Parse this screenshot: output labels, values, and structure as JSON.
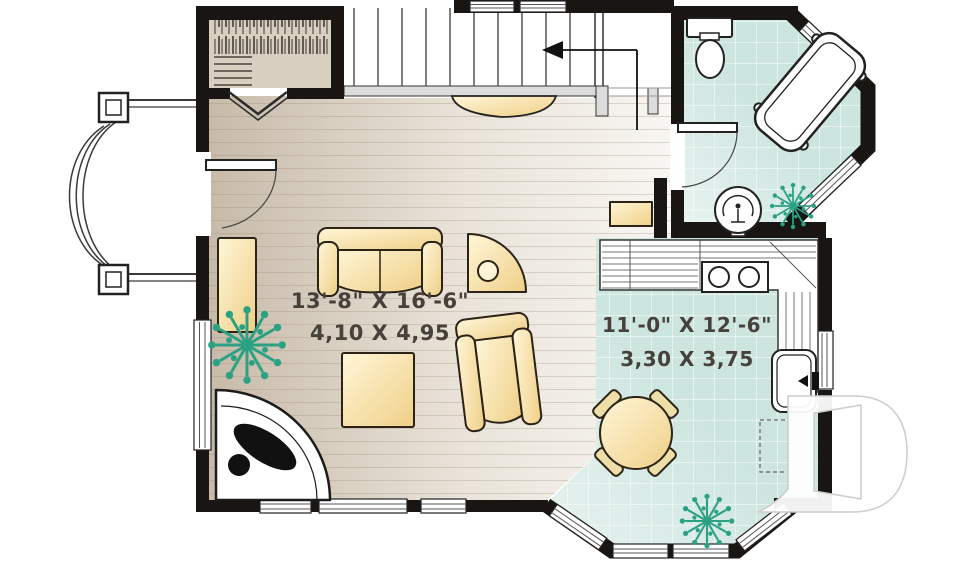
{
  "rooms": {
    "living_room": {
      "imperial": "13'-8\" X 16'-6\"",
      "metric": "4,10 X 4,95"
    },
    "kitchen_dining": {
      "imperial": "11'-0\" X 12'-6\"",
      "metric": "3,30 X 3,75"
    }
  },
  "watermark": {
    "letter": "D"
  },
  "colors": {
    "wall": "#191512",
    "wood_floor": "#cabdac",
    "tile_floor": "#cde5df",
    "furniture": "#f6e2a8",
    "plant": "#2aa183"
  }
}
